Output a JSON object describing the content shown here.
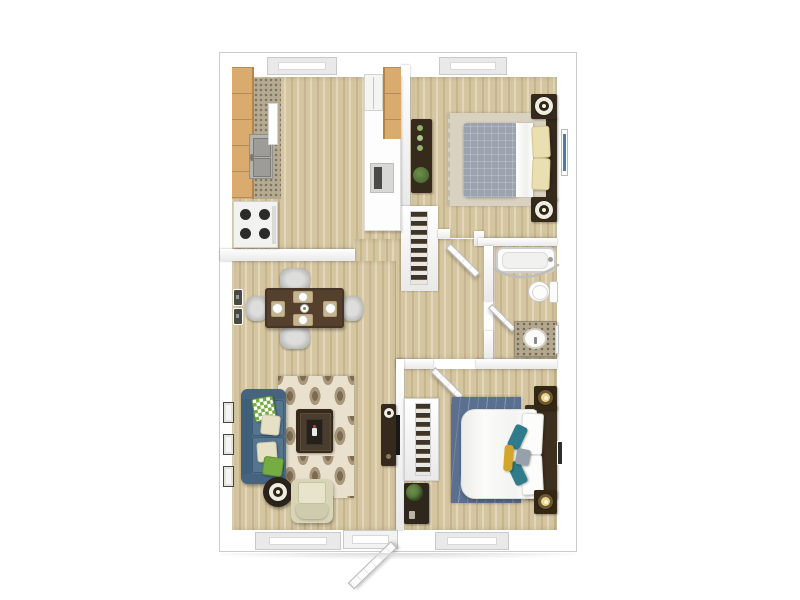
{
  "meta": {
    "view": "3d-top-down-floor-plan",
    "background": "#ffffff"
  },
  "palette": {
    "wall": "#ffffff",
    "wall-shade": "#e9e9e9",
    "outline": "#cccccc",
    "floor": "#d5c6a0",
    "cabinet": "#d9ab6f",
    "cabinet-edge": "#b4854a",
    "counter-speckle": "#b5ab93",
    "stainless": "#b4b3af",
    "dark-wood": "#362a1c",
    "table-wood": "#55402e",
    "chair-gray": "#b9b9b7",
    "sofa": "#4d6d87",
    "sofa-dark": "#40607a",
    "rug-base": "#e9e0cd",
    "rug-motif": "#a8977b",
    "rug-motif-dark": "#7c6a52",
    "rug-beige": "#d9d2c1",
    "rug-blue": "#5b7090",
    "cream": "#e6e1c4",
    "pillow-cream": "#eadfb0",
    "green": "#75ad42",
    "blanket-gray": "#9ba4ae",
    "teal": "#2f7b8c",
    "yellow": "#d2a62a",
    "gray-pillow": "#97a1ab",
    "granite": "#b3a88f",
    "glow": "#ecd489",
    "plant": "#4e6d35",
    "screen-blue": "#4b7ca1"
  },
  "rooms": [
    {
      "name": "kitchen",
      "furniture": [
        "upper-cabinets",
        "countertop",
        "double-sink",
        "stove",
        "refrigerator",
        "wall-oven",
        "right-counter",
        "window"
      ]
    },
    {
      "name": "bedroom-1",
      "furniture": [
        "bed-gray-blanket",
        "two-cream-pillows",
        "headboard",
        "nightstand-with-lamp-x2",
        "dresser-with-plant",
        "area-rug",
        "wall-tv",
        "window",
        "reach-in-closet"
      ]
    },
    {
      "name": "bathroom",
      "furniture": [
        "bathtub-with-curved-rod",
        "toilet",
        "granite-vanity-with-sink",
        "mirror",
        "door"
      ]
    },
    {
      "name": "dining-area",
      "furniture": [
        "square-table",
        "four-chairs",
        "four-place-settings",
        "centerpiece",
        "wall-switches"
      ]
    },
    {
      "name": "living-room",
      "furniture": [
        "teal-sofa",
        "throw-pillows",
        "ogee-pattern-rug",
        "coffee-table",
        "armchair",
        "round-side-table-with-lamp",
        "tv-console",
        "wall-tv",
        "three-side-windows",
        "front-door",
        "window"
      ]
    },
    {
      "name": "bedroom-2",
      "furniture": [
        "white-bed",
        "accent-pillows",
        "blue-rug",
        "headboard",
        "nightstand-with-lamp-x2",
        "shoe-closet",
        "dresser-with-plant",
        "wall-art",
        "door",
        "window"
      ]
    },
    {
      "name": "hallway",
      "furniture": [
        "linen-closet"
      ]
    }
  ]
}
